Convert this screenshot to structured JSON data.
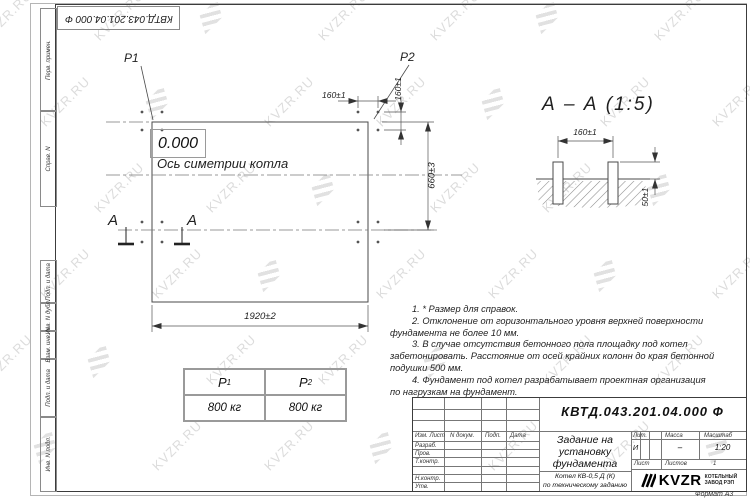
{
  "watermark": {
    "text": "KVZR.RU"
  },
  "stamp": {
    "doc_number": "КВТД.043.201.04.000 Ф"
  },
  "frame_left": {
    "cell1": "Перв. примен.",
    "cell2": "Справ. N",
    "cell3": "Подп. и дата",
    "cell4": "Инв. N дубл.",
    "cell5": "Взам. инв. N",
    "cell6": "Подп. и дата",
    "cell7": "Инв. N подл."
  },
  "plan": {
    "p1": "P1",
    "p2": "P2",
    "level": "0.000",
    "axis": "Ось симетрии котла",
    "section_letter_left": "А",
    "section_letter_right": "А",
    "dim_width": "1920±2",
    "dim_height": "660±3",
    "dim_pitch_h": "160±1",
    "dim_pitch_v": "160±1"
  },
  "section": {
    "title": "А – А (1:5)",
    "dim_spacing": "160±1",
    "dim_height": "50±1"
  },
  "notes": {
    "lines": [
      "1. * Размер для справок.",
      "2. Отклонение от горизонтального уровня верхней поверхности",
      "фундамента не более 10 мм.",
      "3. В случае отсутствия бетонного пола площадку под котел",
      "забетонировать. Расстояние от осей крайних колонн до края бетонной",
      "подушки 500 мм.",
      "4. Фундамент под котел разрабатывает проектная организация",
      "по нагрузкам на фундамент."
    ]
  },
  "load_table": {
    "col1": {
      "base": "P",
      "sub": "1",
      "value": "800 кг"
    },
    "col2": {
      "base": "P",
      "sub": "2",
      "value": "800 кг"
    }
  },
  "title_block": {
    "doc_number": "КВТД.043.201.04.000 Ф",
    "header_cells": [
      "Изм. Лист",
      "N докум.",
      "Подп.",
      "Дата"
    ],
    "sig_labels": [
      "Разраб.",
      "Пров.",
      "Т.контр.",
      "Н.контр.",
      "Утв."
    ],
    "title_line1": "Задание на",
    "title_line2": "установку",
    "title_line3": "фундамента",
    "subtitle_line1": "Котел КВ-0,5 Д (К)",
    "subtitle_line2": "по техническому заданию",
    "lit_header": "Лит.",
    "mass_header": "Масса",
    "scale_header": "Масштаб",
    "lit_value": "И",
    "mass_value": "–",
    "scale_value": "1:20",
    "sheet_label": "Лист",
    "sheets_label": "Листов",
    "sheets_value": "1",
    "logo_text": "KVZR",
    "logo_caption1": "КОТЕЛЬНЫЙ",
    "logo_caption2": "ЗАВОД РЭП",
    "format_label": "Формат А3"
  }
}
